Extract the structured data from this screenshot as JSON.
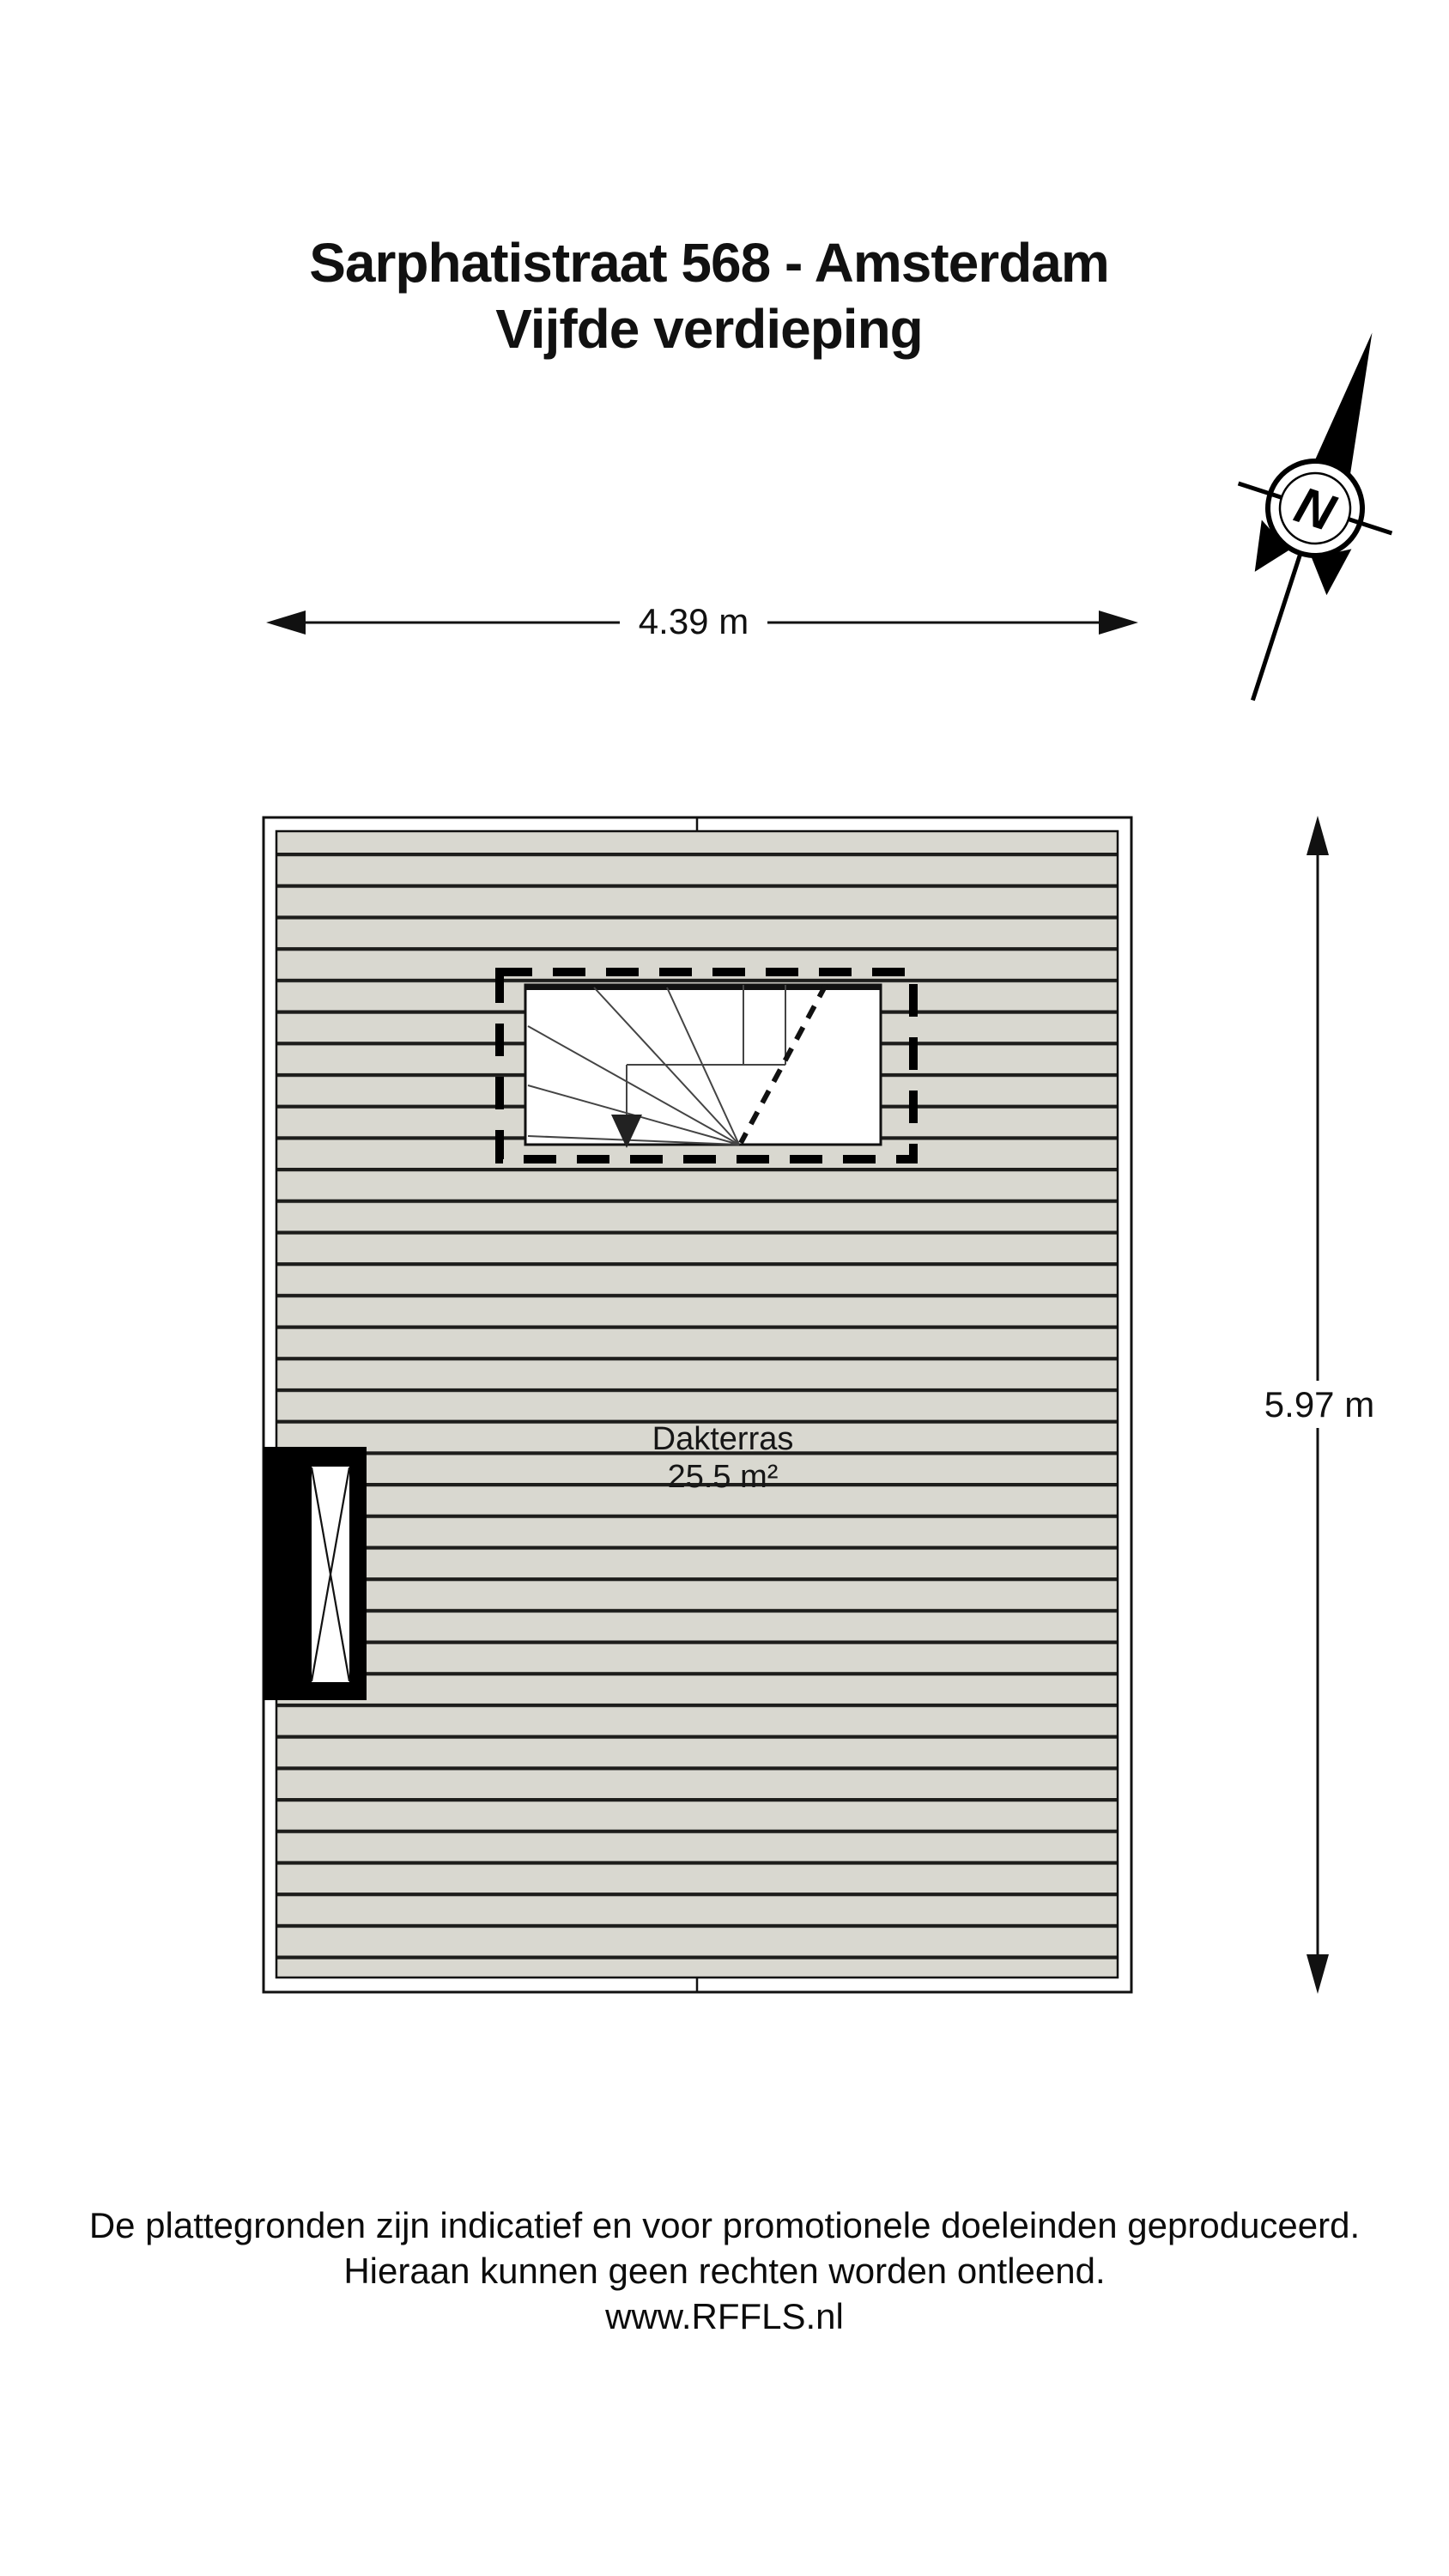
{
  "title": {
    "line1": "Sarphatistraat 568 - Amsterdam",
    "line2": "Vijfde verdieping"
  },
  "compass": {
    "label": "N"
  },
  "dimensions": {
    "width": "4.39 m",
    "height": "5.97 m"
  },
  "room": {
    "name": "Dakterras",
    "area": "25.5 m²"
  },
  "footer": {
    "line1": "De plattegronden zijn indicatief en voor promotionele doeleinden geproduceerd.",
    "line2": "Hieraan kunnen geen rechten worden ontleend.",
    "line3": "www.RFFLS.nl"
  },
  "colors": {
    "decking_fill": "#d9d8d0",
    "line_color": "#1d1d1b",
    "accent": "#000000"
  }
}
